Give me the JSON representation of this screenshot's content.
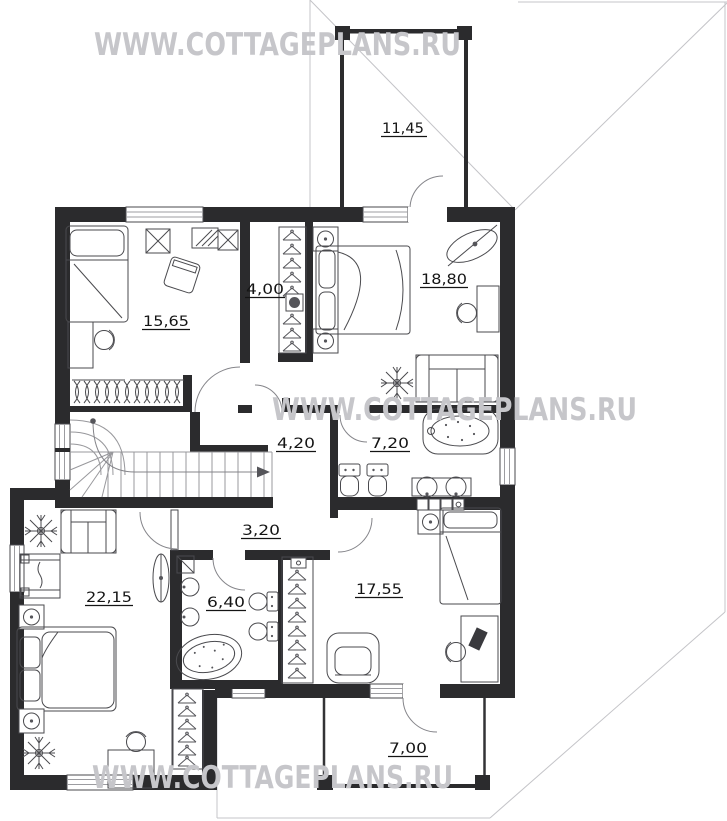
{
  "floor_plan": {
    "watermark": "WWW.COTTAGEPLANS.RU",
    "areas": {
      "balcony": "11,45",
      "bedroom_top_left": "15,65",
      "dressing_room": "4,00",
      "bedroom_top_right": "18,80",
      "stair_hall": "4,20",
      "bathroom_top": "7,20",
      "corridor": "3,20",
      "bedroom_bottom_left": "22,15",
      "bathroom_bottom": "6,40",
      "bedroom_bottom_right": "17,55",
      "terrace": "7,00"
    },
    "colors": {
      "wall": "#2b2b2d",
      "furniture_line": "#4a4a4e",
      "roof_outline": "#c4c4c8",
      "watermark": "#c6c6ca",
      "label": "#141414",
      "background": "#ffffff"
    }
  }
}
